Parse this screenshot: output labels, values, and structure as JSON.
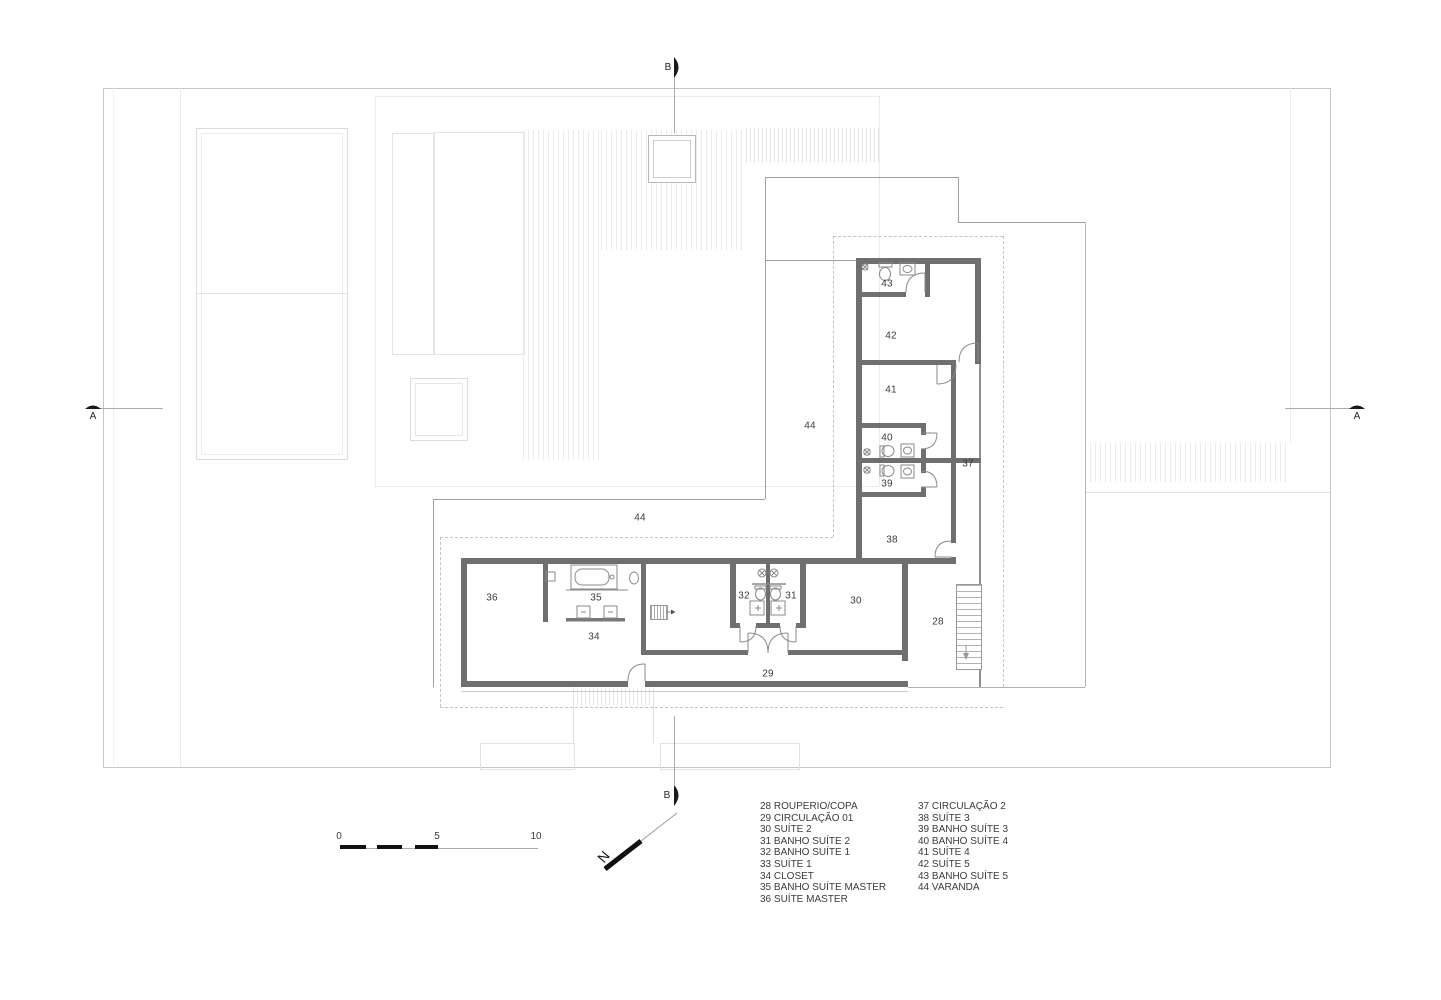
{
  "colors": {
    "wall": "#6f6f6f",
    "thin": "#a0a0a0",
    "faint": "#e7e7e7",
    "dash": "#c4c4c4",
    "ink": "#3b3b3b",
    "mark": "#1a1a1a"
  },
  "plan": {
    "room_labels": [
      {
        "num": "43",
        "x": 887,
        "y": 284
      },
      {
        "num": "42",
        "x": 891,
        "y": 336
      },
      {
        "num": "41",
        "x": 891,
        "y": 390
      },
      {
        "num": "40",
        "x": 887,
        "y": 438
      },
      {
        "num": "39",
        "x": 887,
        "y": 484
      },
      {
        "num": "37",
        "x": 968,
        "y": 464
      },
      {
        "num": "38",
        "x": 892,
        "y": 540
      },
      {
        "num": "44",
        "x": 810,
        "y": 426
      },
      {
        "num": "44",
        "x": 640,
        "y": 518
      },
      {
        "num": "36",
        "x": 492,
        "y": 598
      },
      {
        "num": "35",
        "x": 596,
        "y": 598
      },
      {
        "num": "34",
        "x": 594,
        "y": 637
      },
      {
        "num": "32",
        "x": 744,
        "y": 596
      },
      {
        "num": "31",
        "x": 791,
        "y": 596
      },
      {
        "num": "30",
        "x": 856,
        "y": 601
      },
      {
        "num": "28",
        "x": 938,
        "y": 622
      },
      {
        "num": "29",
        "x": 768,
        "y": 674
      }
    ]
  },
  "legend": {
    "left": [
      "28 ROUPERIO/COPA",
      "29 CIRCULAÇÃO 01",
      "30 SUÍTE 2",
      "31 BANHO SUÍTE 2",
      "32 BANHO SUÍTE 1",
      "33 SUÍTE 1",
      "34 CLOSET",
      "35 BANHO SUÍTE MASTER",
      "36 SUÍTE MASTER"
    ],
    "right": [
      "37 CIRCULAÇÃO 2",
      "38 SUÍTE 3",
      "39 BANHO SUÍTE 3",
      "40 BANHO SUÍTE 4",
      "41 SUÍTE 4",
      "42 SUÍTE 5",
      "43 BANHO SUÍTE 5",
      "44 VARANDA"
    ]
  },
  "scale_bar": {
    "ticks": [
      {
        "label": "0",
        "x": 339
      },
      {
        "label": "5",
        "x": 437
      },
      {
        "label": "10",
        "x": 536
      }
    ]
  },
  "section_markers": {
    "a_left": "A",
    "a_right": "A",
    "b_top": "B",
    "b_bottom": "B"
  },
  "north_arrow": {
    "label": "N"
  }
}
